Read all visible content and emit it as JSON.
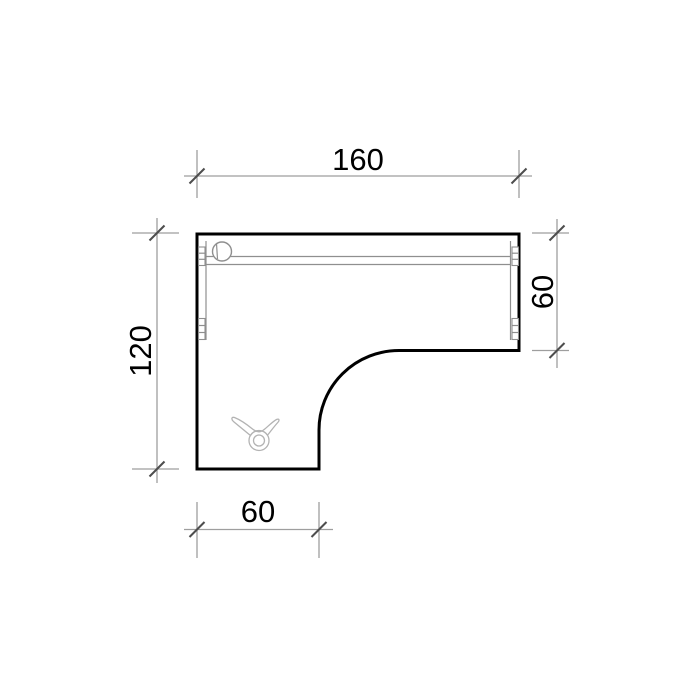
{
  "drawing": {
    "dimensions": {
      "top_width": "160",
      "left_depth": "120",
      "right_depth": "60",
      "bottom_width": "60"
    },
    "symbols": {
      "top_left_circle": "cable-grommet-icon",
      "lower_shape": "castor-clip-icon",
      "edge_blocks": "connector-fitting-icon",
      "tick_style": "oblique-45deg-tick"
    },
    "colors": {
      "outline": "#000000",
      "dimension_line": "#9e9e9e",
      "tick_mark": "#4d4d4d",
      "detail_line": "#8f8f8f",
      "symbol_line": "#b3b3b3",
      "text": "#000000",
      "background": "#ffffff"
    }
  }
}
